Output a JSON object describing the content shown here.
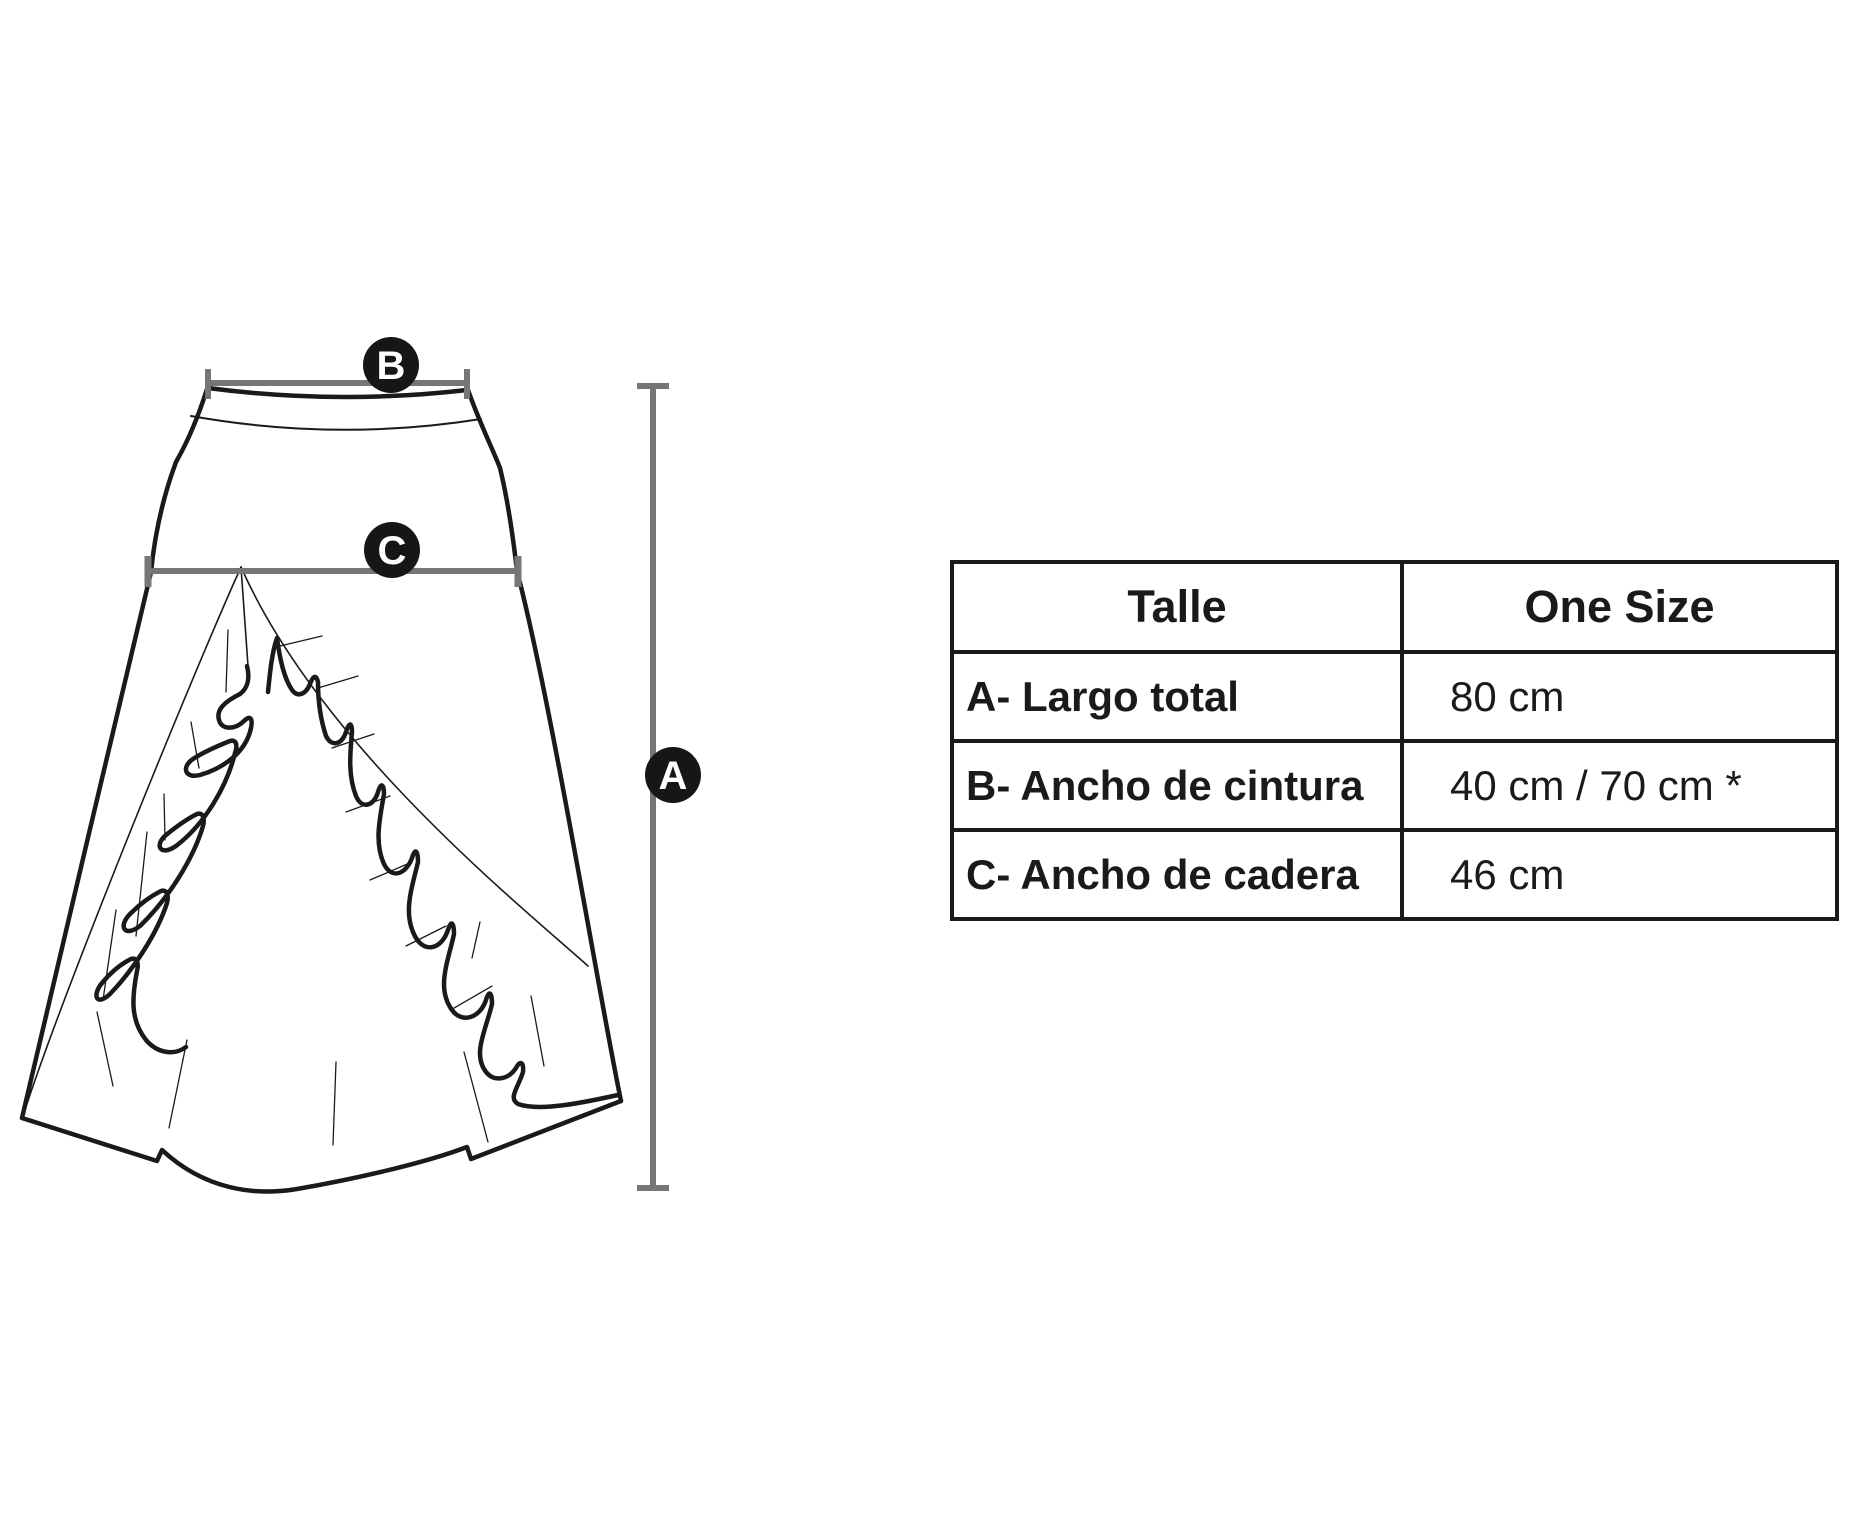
{
  "diagram": {
    "labels": {
      "a": "A",
      "b": "B",
      "c": "C"
    }
  },
  "table": {
    "header": {
      "col1": "Talle",
      "col2": "One Size"
    },
    "rows": [
      {
        "label": "A- Largo total",
        "value": "80 cm"
      },
      {
        "label": "B- Ancho de cintura",
        "value": "40 cm / 70 cm *"
      },
      {
        "label": "C- Ancho de cadera",
        "value": "46 cm"
      }
    ]
  },
  "colors": {
    "sketch_line": "#1a1a1a",
    "measure_line": "#767676",
    "badge_fill": "#161616",
    "badge_text": "#ffffff",
    "table_border": "#1a1a1a",
    "background": "#ffffff"
  }
}
